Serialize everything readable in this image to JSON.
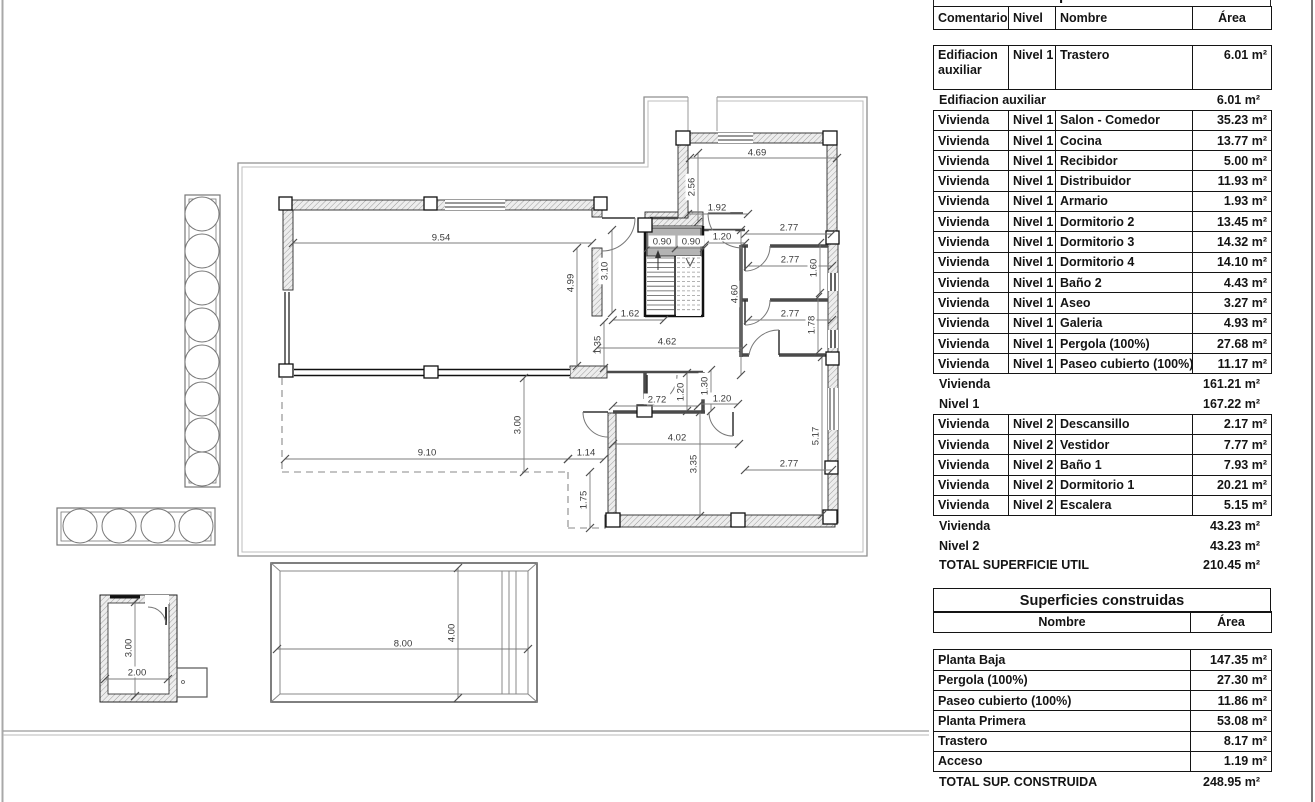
{
  "plan": {
    "dimensions": [
      {
        "l": "9.54",
        "x1": 293,
        "y1": 243,
        "x2": 592,
        "y2": 243,
        "tx": 441,
        "ty": 237,
        "r": 0
      },
      {
        "l": "4.99",
        "x1": 577,
        "y1": 248,
        "x2": 577,
        "y2": 366,
        "tx": 570,
        "ty": 283,
        "r": 90
      },
      {
        "l": "3.10",
        "x1": 612,
        "y1": 230,
        "x2": 612,
        "y2": 313,
        "tx": 604,
        "ty": 271,
        "r": 90
      },
      {
        "l": "0.90",
        "x1": 648,
        "y1": 248,
        "x2": 676,
        "y2": 248,
        "tx": 662,
        "ty": 241,
        "r": 0
      },
      {
        "l": "0.90",
        "x1": 676,
        "y1": 248,
        "x2": 704,
        "y2": 248,
        "tx": 691,
        "ty": 241,
        "r": 0
      },
      {
        "l": "1.92",
        "x1": 688,
        "y1": 214,
        "x2": 748,
        "y2": 214,
        "tx": 717,
        "ty": 207,
        "r": 0
      },
      {
        "l": "1.20",
        "x1": 707,
        "y1": 243,
        "x2": 745,
        "y2": 243,
        "tx": 722,
        "ty": 236,
        "r": 0
      },
      {
        "l": "2.56",
        "x1": 698,
        "y1": 153,
        "x2": 698,
        "y2": 222,
        "tx": 691,
        "ty": 187,
        "r": 90
      },
      {
        "l": "4.69",
        "x1": 690,
        "y1": 158,
        "x2": 837,
        "y2": 158,
        "tx": 757,
        "ty": 152,
        "r": 0
      },
      {
        "l": "2.77",
        "x1": 745,
        "y1": 234,
        "x2": 832,
        "y2": 234,
        "tx": 789,
        "ty": 227,
        "r": 0
      },
      {
        "l": "2.77",
        "x1": 748,
        "y1": 266,
        "x2": 832,
        "y2": 266,
        "tx": 790,
        "ty": 259,
        "r": 0
      },
      {
        "l": "1.60",
        "x1": 820,
        "y1": 243,
        "x2": 820,
        "y2": 293,
        "tx": 813,
        "ty": 268,
        "r": 90
      },
      {
        "l": "2.77",
        "x1": 748,
        "y1": 320,
        "x2": 832,
        "y2": 320,
        "tx": 790,
        "ty": 313,
        "r": 0
      },
      {
        "l": "1.78",
        "x1": 818,
        "y1": 297,
        "x2": 818,
        "y2": 352,
        "tx": 811,
        "ty": 325,
        "r": 90
      },
      {
        "l": "1.62",
        "x1": 613,
        "y1": 320,
        "x2": 664,
        "y2": 320,
        "tx": 630,
        "ty": 313,
        "r": 0
      },
      {
        "l": "1.35",
        "x1": 604,
        "y1": 322,
        "x2": 604,
        "y2": 368,
        "tx": 597,
        "ty": 345,
        "r": 90
      },
      {
        "l": "4.62",
        "x1": 597,
        "y1": 348,
        "x2": 743,
        "y2": 348,
        "tx": 667,
        "ty": 341,
        "r": 0
      },
      {
        "l": "4.60",
        "x1": 741,
        "y1": 230,
        "x2": 741,
        "y2": 375,
        "tx": 734,
        "ty": 294,
        "r": 90
      },
      {
        "l": "2.72",
        "x1": 613,
        "y1": 406,
        "x2": 698,
        "y2": 406,
        "tx": 657,
        "ty": 399,
        "r": 0
      },
      {
        "l": "1.20",
        "x1": 687,
        "y1": 373,
        "x2": 687,
        "y2": 411,
        "tx": 680,
        "ty": 392,
        "r": 90
      },
      {
        "l": "1.30",
        "x1": 711,
        "y1": 370,
        "x2": 711,
        "y2": 411,
        "tx": 704,
        "ty": 386,
        "r": 90
      },
      {
        "l": "1.20",
        "x1": 700,
        "y1": 404,
        "x2": 738,
        "y2": 404,
        "tx": 722,
        "ty": 398,
        "r": 0
      },
      {
        "l": "4.02",
        "x1": 613,
        "y1": 444,
        "x2": 739,
        "y2": 444,
        "tx": 677,
        "ty": 437,
        "r": 0
      },
      {
        "l": "3.35",
        "x1": 700,
        "y1": 412,
        "x2": 700,
        "y2": 516,
        "tx": 693,
        "ty": 464,
        "r": 90
      },
      {
        "l": "5.17",
        "x1": 822,
        "y1": 357,
        "x2": 822,
        "y2": 515,
        "tx": 815,
        "ty": 436,
        "r": 90
      },
      {
        "l": "2.77",
        "x1": 745,
        "y1": 470,
        "x2": 832,
        "y2": 470,
        "tx": 789,
        "ty": 463,
        "r": 0
      },
      {
        "l": "3.00",
        "x1": 524,
        "y1": 378,
        "x2": 524,
        "y2": 472,
        "tx": 517,
        "ty": 425,
        "r": 90
      },
      {
        "l": "9.10",
        "x1": 285,
        "y1": 459,
        "x2": 568,
        "y2": 459,
        "tx": 427,
        "ty": 452,
        "r": 0
      },
      {
        "l": "1.14",
        "x1": 568,
        "y1": 459,
        "x2": 604,
        "y2": 459,
        "tx": 586,
        "ty": 452,
        "r": 0
      },
      {
        "l": "1.75",
        "x1": 590,
        "y1": 472,
        "x2": 590,
        "y2": 528,
        "tx": 583,
        "ty": 500,
        "r": 90
      },
      {
        "l": "8.00",
        "x1": 277,
        "y1": 649,
        "x2": 528,
        "y2": 649,
        "tx": 403,
        "ty": 643,
        "r": 0
      },
      {
        "l": "4.00",
        "x1": 458,
        "y1": 568,
        "x2": 458,
        "y2": 698,
        "tx": 451,
        "ty": 633,
        "r": 90
      },
      {
        "l": "3.00",
        "x1": 135,
        "y1": 602,
        "x2": 135,
        "y2": 696,
        "tx": 128,
        "ty": 648,
        "r": 90
      },
      {
        "l": "2.00",
        "x1": 105,
        "y1": 679,
        "x2": 168,
        "y2": 679,
        "tx": 137,
        "ty": 672,
        "r": 0
      }
    ]
  },
  "tables": {
    "utiles": {
      "clipped_title": "Superficies utiles",
      "headers": [
        "Comentarios",
        "Nivel",
        "Nombre",
        "Área"
      ],
      "rows": [
        {
          "type": "data",
          "tall": true,
          "comentarios": "Edifiacion auxiliar",
          "nivel": "Nivel 1",
          "nombre": "Trastero",
          "area": "6.01 m²"
        },
        {
          "type": "subtotal",
          "label": "Edifiacion auxiliar",
          "area": "6.01 m²"
        },
        {
          "type": "data",
          "comentarios": "Vivienda",
          "nivel": "Nivel 1",
          "nombre": "Salon - Comedor",
          "area": "35.23 m²"
        },
        {
          "type": "data",
          "comentarios": "Vivienda",
          "nivel": "Nivel 1",
          "nombre": "Cocina",
          "area": "13.77 m²"
        },
        {
          "type": "data",
          "comentarios": "Vivienda",
          "nivel": "Nivel 1",
          "nombre": "Recibidor",
          "area": "5.00 m²"
        },
        {
          "type": "data",
          "comentarios": "Vivienda",
          "nivel": "Nivel 1",
          "nombre": "Distribuidor",
          "area": "11.93 m²"
        },
        {
          "type": "data",
          "comentarios": "Vivienda",
          "nivel": "Nivel 1",
          "nombre": "Armario",
          "area": "1.93 m²"
        },
        {
          "type": "data",
          "comentarios": "Vivienda",
          "nivel": "Nivel 1",
          "nombre": "Dormitorio 2",
          "area": "13.45 m²"
        },
        {
          "type": "data",
          "comentarios": "Vivienda",
          "nivel": "Nivel 1",
          "nombre": "Dormitorio 3",
          "area": "14.32 m²"
        },
        {
          "type": "data",
          "comentarios": "Vivienda",
          "nivel": "Nivel 1",
          "nombre": "Dormitorio 4",
          "area": "14.10 m²"
        },
        {
          "type": "data",
          "comentarios": "Vivienda",
          "nivel": "Nivel 1",
          "nombre": "Baño 2",
          "area": "4.43 m²"
        },
        {
          "type": "data",
          "comentarios": "Vivienda",
          "nivel": "Nivel 1",
          "nombre": "Aseo",
          "area": "3.27 m²"
        },
        {
          "type": "data",
          "comentarios": "Vivienda",
          "nivel": "Nivel 1",
          "nombre": "Galeria",
          "area": "4.93 m²"
        },
        {
          "type": "data",
          "comentarios": "Vivienda",
          "nivel": "Nivel 1",
          "nombre": "Pergola (100%)",
          "area": "27.68 m²"
        },
        {
          "type": "data",
          "comentarios": "Vivienda",
          "nivel": "Nivel 1",
          "nombre": "Paseo cubierto (100%)",
          "area": "11.17 m²"
        },
        {
          "type": "subtotal",
          "label": "Vivienda",
          "area": "161.21 m²"
        },
        {
          "type": "subtotal",
          "label": "Nivel 1",
          "area": "167.22 m²"
        },
        {
          "type": "data",
          "comentarios": "Vivienda",
          "nivel": "Nivel 2",
          "nombre": "Descansillo",
          "area": "2.17 m²"
        },
        {
          "type": "data",
          "comentarios": "Vivienda",
          "nivel": "Nivel 2",
          "nombre": "Vestidor",
          "area": "7.77 m²"
        },
        {
          "type": "data",
          "comentarios": "Vivienda",
          "nivel": "Nivel 2",
          "nombre": "Baño 1",
          "area": "7.93 m²"
        },
        {
          "type": "data",
          "comentarios": "Vivienda",
          "nivel": "Nivel 2",
          "nombre": "Dormitorio 1",
          "area": "20.21 m²"
        },
        {
          "type": "data",
          "comentarios": "Vivienda",
          "nivel": "Nivel 2",
          "nombre": "Escalera",
          "area": "5.15 m²"
        },
        {
          "type": "subtotal",
          "label": "Vivienda",
          "area": "43.23 m²"
        },
        {
          "type": "subtotal",
          "label": "Nivel 2",
          "area": "43.23 m²"
        },
        {
          "type": "total",
          "label": "TOTAL SUPERFICIE UTIL",
          "area": "210.45 m²"
        }
      ]
    },
    "construidas": {
      "title": "Superficies construidas",
      "headers": [
        "Nombre",
        "Área"
      ],
      "rows": [
        {
          "type": "data",
          "nombre": "Planta Baja",
          "area": "147.35 m²"
        },
        {
          "type": "data",
          "nombre": "Pergola (100%)",
          "area": "27.30 m²"
        },
        {
          "type": "data",
          "nombre": "Paseo cubierto (100%)",
          "area": "11.86 m²"
        },
        {
          "type": "data",
          "nombre": "Planta Primera",
          "area": "53.08 m²"
        },
        {
          "type": "data",
          "nombre": "Trastero",
          "area": "8.17 m²"
        },
        {
          "type": "data",
          "nombre": "Acceso",
          "area": "1.19 m²"
        },
        {
          "type": "total",
          "label": "TOTAL SUP. CONSTRUIDA",
          "area": "248.95 m²"
        }
      ]
    }
  }
}
